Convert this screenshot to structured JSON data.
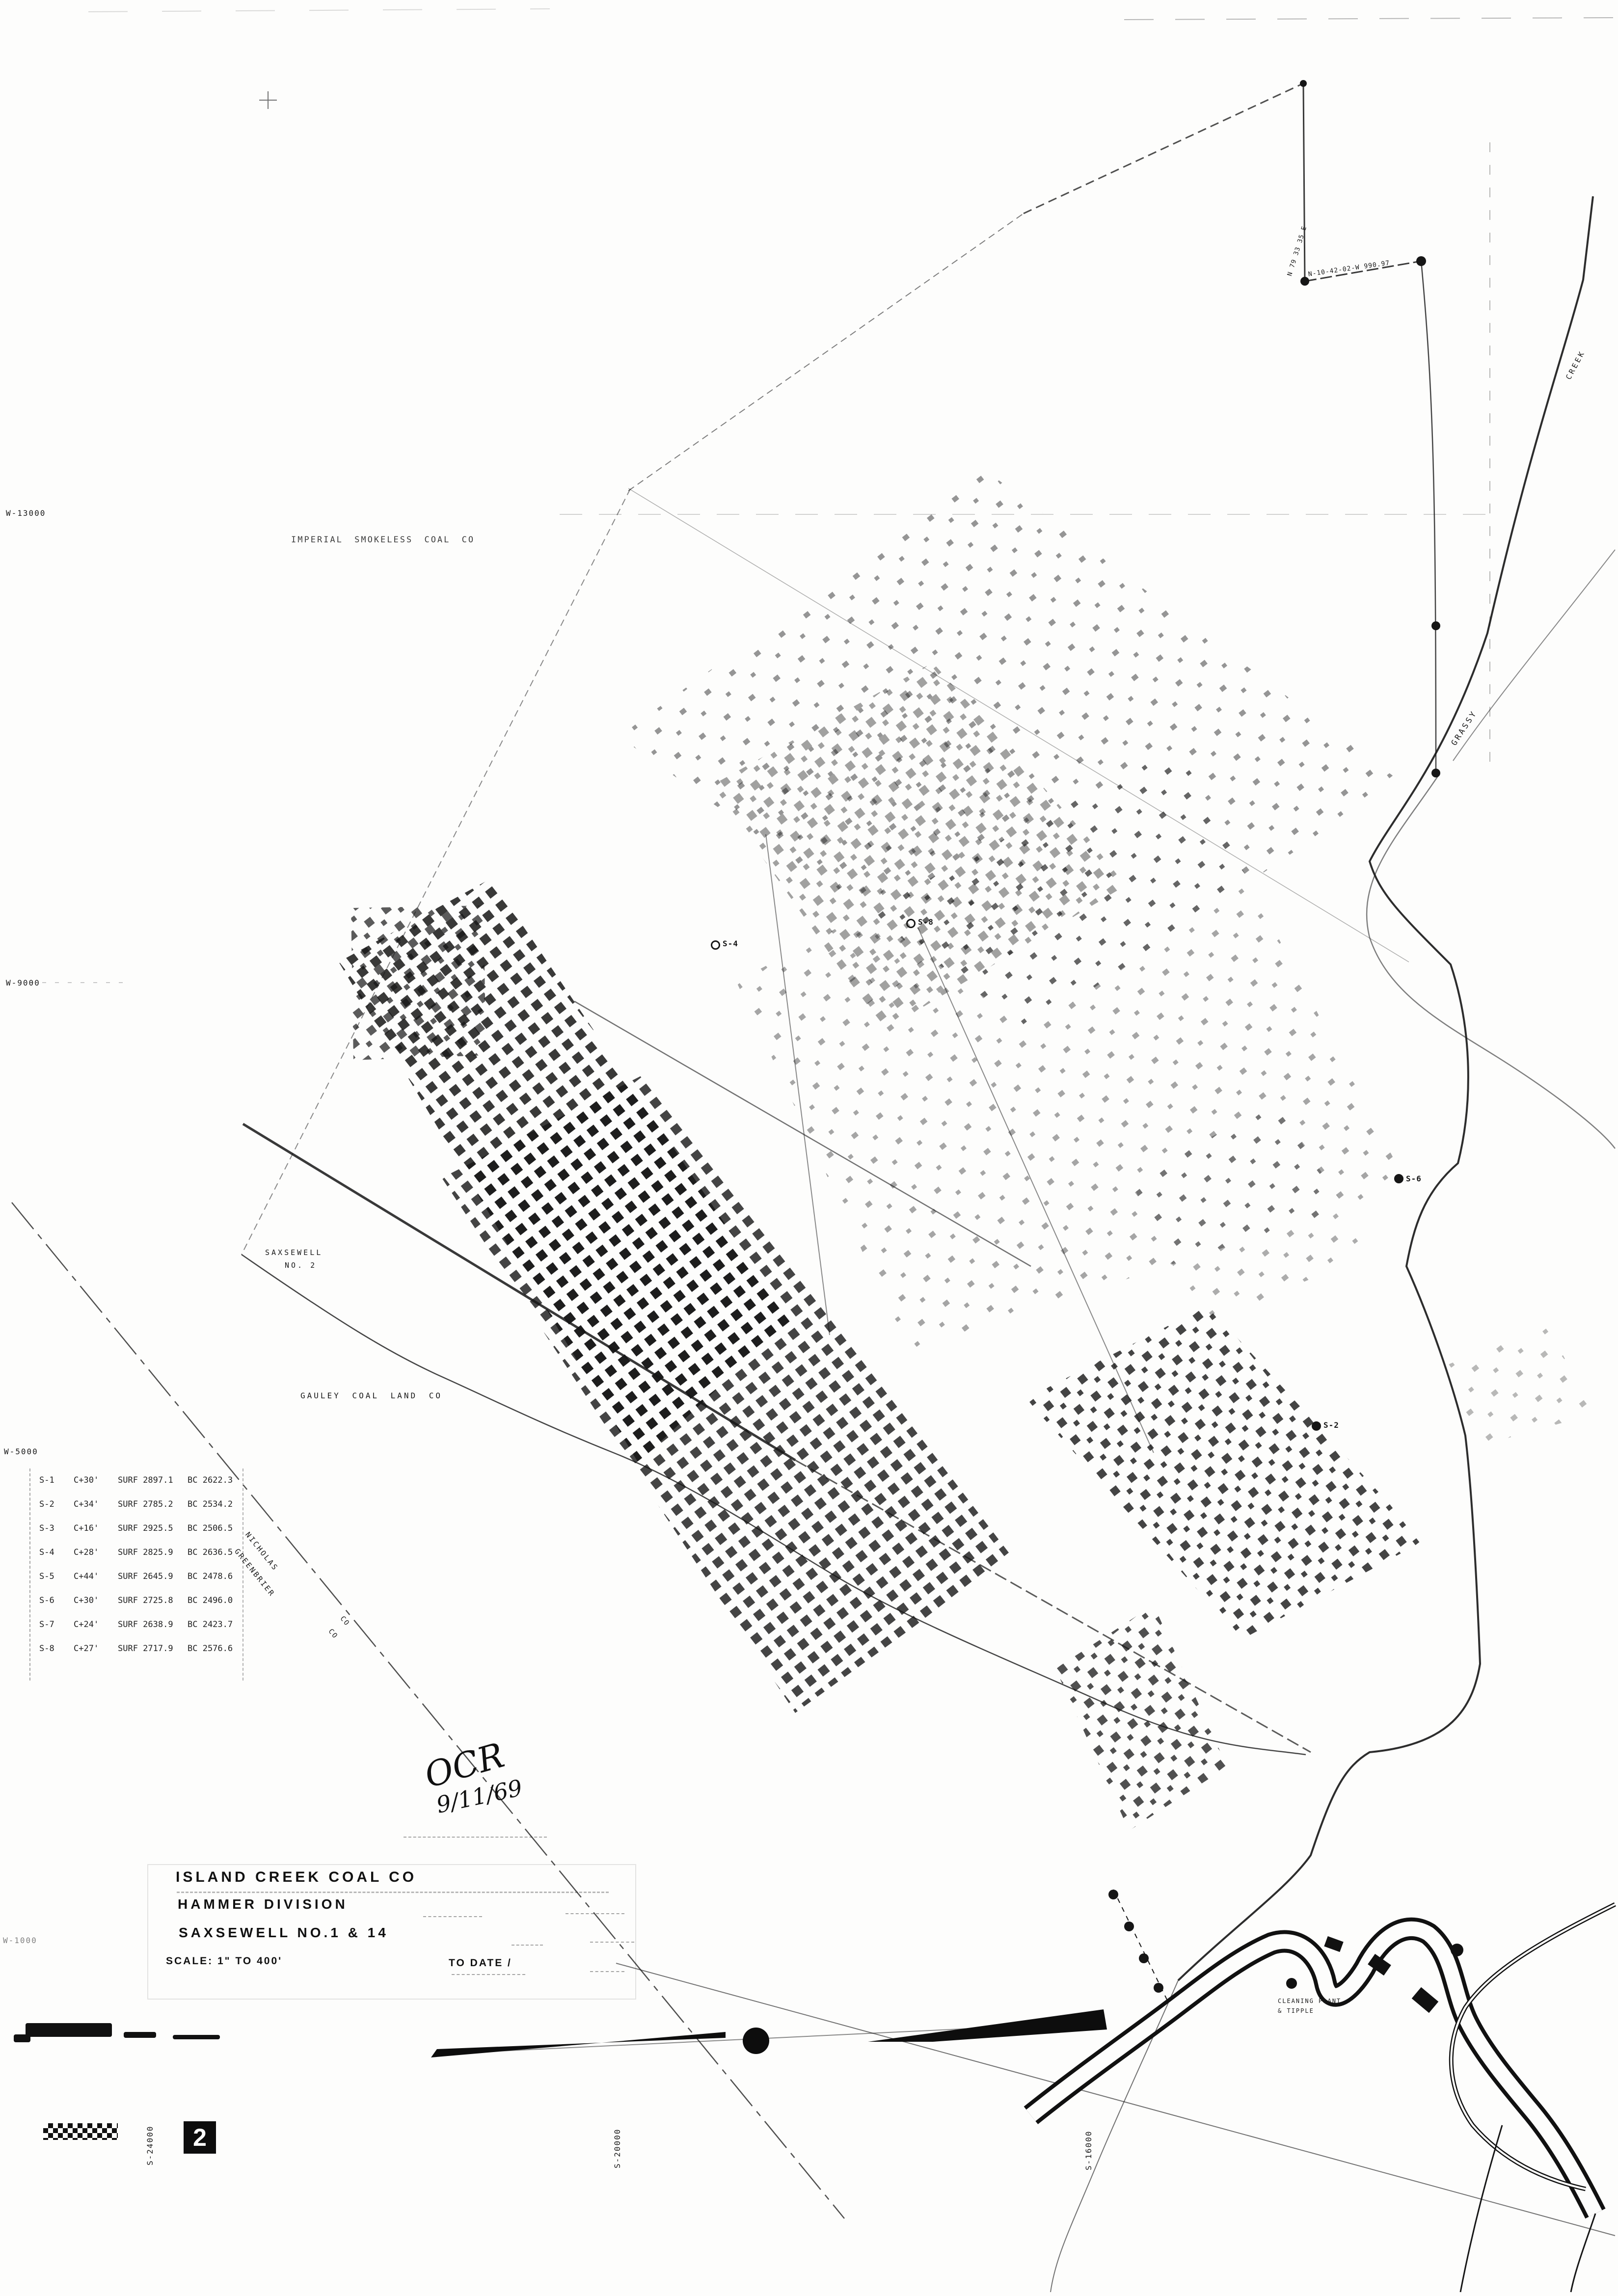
{
  "colors": {
    "ink": "#161616",
    "paper": "#fdfdfc"
  },
  "sheet_number": "2",
  "title_block": {
    "company": "ISLAND CREEK COAL CO",
    "division": "HAMMER DIVISION",
    "mine": "SAXSEWELL NO.1 & 14",
    "scale": "SCALE: 1\" TO 400'",
    "to_date": "TO DATE /"
  },
  "handwritten_note": {
    "initials": "OCR",
    "date": "9/11/69"
  },
  "labels": {
    "imperial": "IMPERIAL SMOKELESS COAL CO",
    "gauley": "GAULEY COAL LAND CO",
    "saxsewell_line1": "SAXSEWELL",
    "saxsewell_line2": "NO. 2",
    "cleaning_line1": "CLEANING PLANT",
    "cleaning_line2": "& TIPPLE",
    "county_upper": "NICHOLAS",
    "county_lower": "GREENBRIER",
    "county_upper_co": "CO",
    "county_lower_co": "CO",
    "grassy": "GRASSY",
    "creek": "CREEK",
    "bearing_top": "N-10-42-02-W  990.97",
    "bearing_right": "N 79 33 35 E"
  },
  "grid": {
    "west": [
      "W-13000",
      "W-9000",
      "W-5000",
      "W-1000"
    ],
    "south": [
      "S-24000",
      "S-20000",
      "S-16000"
    ]
  },
  "boreholes": [
    {
      "id": "S-4"
    },
    {
      "id": "S-8"
    },
    {
      "id": "S-6"
    },
    {
      "id": "S-2"
    }
  ],
  "survey_table": {
    "rows": [
      {
        "sta": "S-1",
        "cover": "C+30'",
        "surf": "SURF 2897.1",
        "bc": "BC 2622.3"
      },
      {
        "sta": "S-2",
        "cover": "C+34'",
        "surf": "SURF 2785.2",
        "bc": "BC 2534.2"
      },
      {
        "sta": "S-3",
        "cover": "C+16'",
        "surf": "SURF 2925.5",
        "bc": "BC 2506.5"
      },
      {
        "sta": "S-4",
        "cover": "C+28'",
        "surf": "SURF 2825.9",
        "bc": "BC 2636.5"
      },
      {
        "sta": "S-5",
        "cover": "C+44'",
        "surf": "SURF 2645.9",
        "bc": "BC 2478.6"
      },
      {
        "sta": "S-6",
        "cover": "C+30'",
        "surf": "SURF 2725.8",
        "bc": "BC 2496.0"
      },
      {
        "sta": "S-7",
        "cover": "C+24'",
        "surf": "SURF 2638.9",
        "bc": "BC 2423.7"
      },
      {
        "sta": "S-8",
        "cover": "C+27'",
        "surf": "SURF 2717.9",
        "bc": "BC 2576.6"
      }
    ]
  }
}
